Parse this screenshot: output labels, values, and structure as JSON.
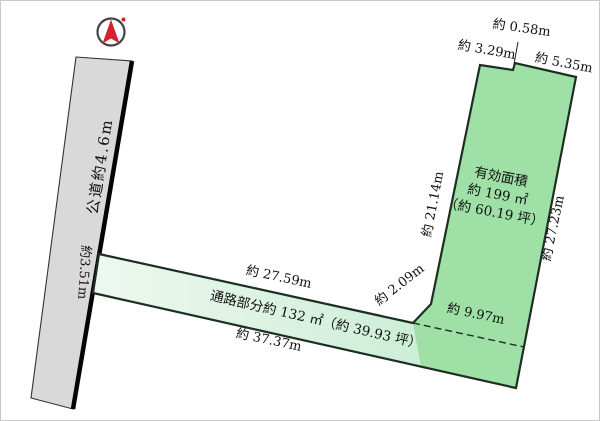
{
  "colors": {
    "road_fill": "#d9d9d9",
    "road_edge": "#050505",
    "road_stroke": "#333333",
    "plot_fill": "#9fe0a6",
    "path_fill_light": "#eef8f0",
    "path_fill_dark": "#cceed7",
    "outline": "#1d2e22",
    "compass_red": "#d32230",
    "text": "#111111"
  },
  "compass": {
    "icon": "north-arrow"
  },
  "road": {
    "label": "公道約4.6m",
    "frontage": "約3.51m"
  },
  "lot": {
    "area_title": "有効面積",
    "area_value": "約 199 ㎡",
    "area_tsubo": "（約 60.19 坪）",
    "dim_top_step": "約 0.58m",
    "dim_top_left": "約 3.29m",
    "dim_top_right": "約 5.35m",
    "dim_left": "約 21.14m",
    "dim_right": "約 27.23m",
    "dim_inner_width": "約 9.97m",
    "dim_connector": "約 2.09m"
  },
  "passage": {
    "label": "通路部分約 132 ㎡（約 39.93 坪）",
    "dim_top": "約 27.59m",
    "dim_bottom": "約 37.37m"
  }
}
